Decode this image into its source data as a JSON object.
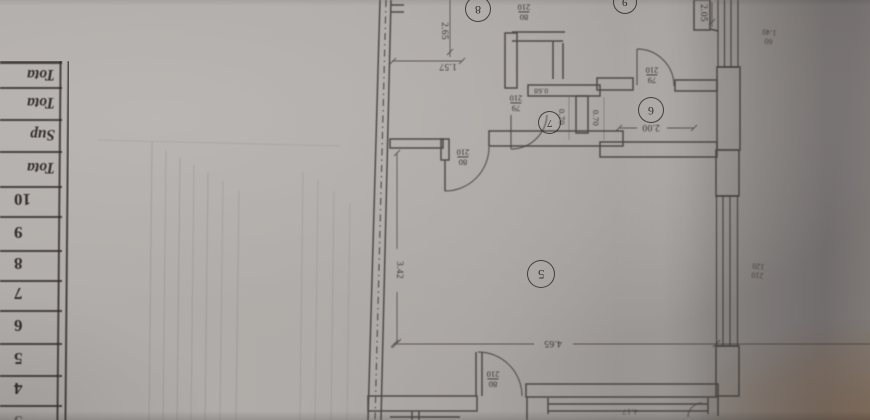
{
  "table": {
    "header_rows": [
      "Tota",
      "Tota",
      "Sup",
      "Tota"
    ],
    "number_rows": [
      "10",
      "9",
      "8",
      "7",
      "6",
      "5",
      "4",
      "3"
    ]
  },
  "plan": {
    "room_labels": {
      "r5": "5",
      "r6": "6",
      "r7": "7",
      "r8": "8",
      "r9": "9"
    },
    "door_labels": {
      "d1": {
        "w": "80",
        "h": "210"
      },
      "d2": {
        "w": "79",
        "h": "210"
      },
      "d3": {
        "w": "79",
        "h": "210"
      },
      "d4": {
        "w": "80",
        "h": "210"
      },
      "d5": {
        "w": "80",
        "h": "210"
      }
    },
    "window_labels": {
      "w1": {
        "w": "60",
        "h": "1.40"
      },
      "w2": {
        "w": "210",
        "h": "120"
      }
    },
    "dimensions": {
      "v265": "2.65",
      "h157": "1.57",
      "v205": "2.05",
      "h200": "2.00",
      "h068": "0.68",
      "v070a": "0.70",
      "v070b": "0.70",
      "v342": "3.42",
      "h465": "4.65",
      "h417": "4.17"
    }
  },
  "colors": {
    "paper": "#aca8a6",
    "ink": "#3a3531",
    "shadow": "#7e7974",
    "warm_corner": "#7f6c5e"
  }
}
